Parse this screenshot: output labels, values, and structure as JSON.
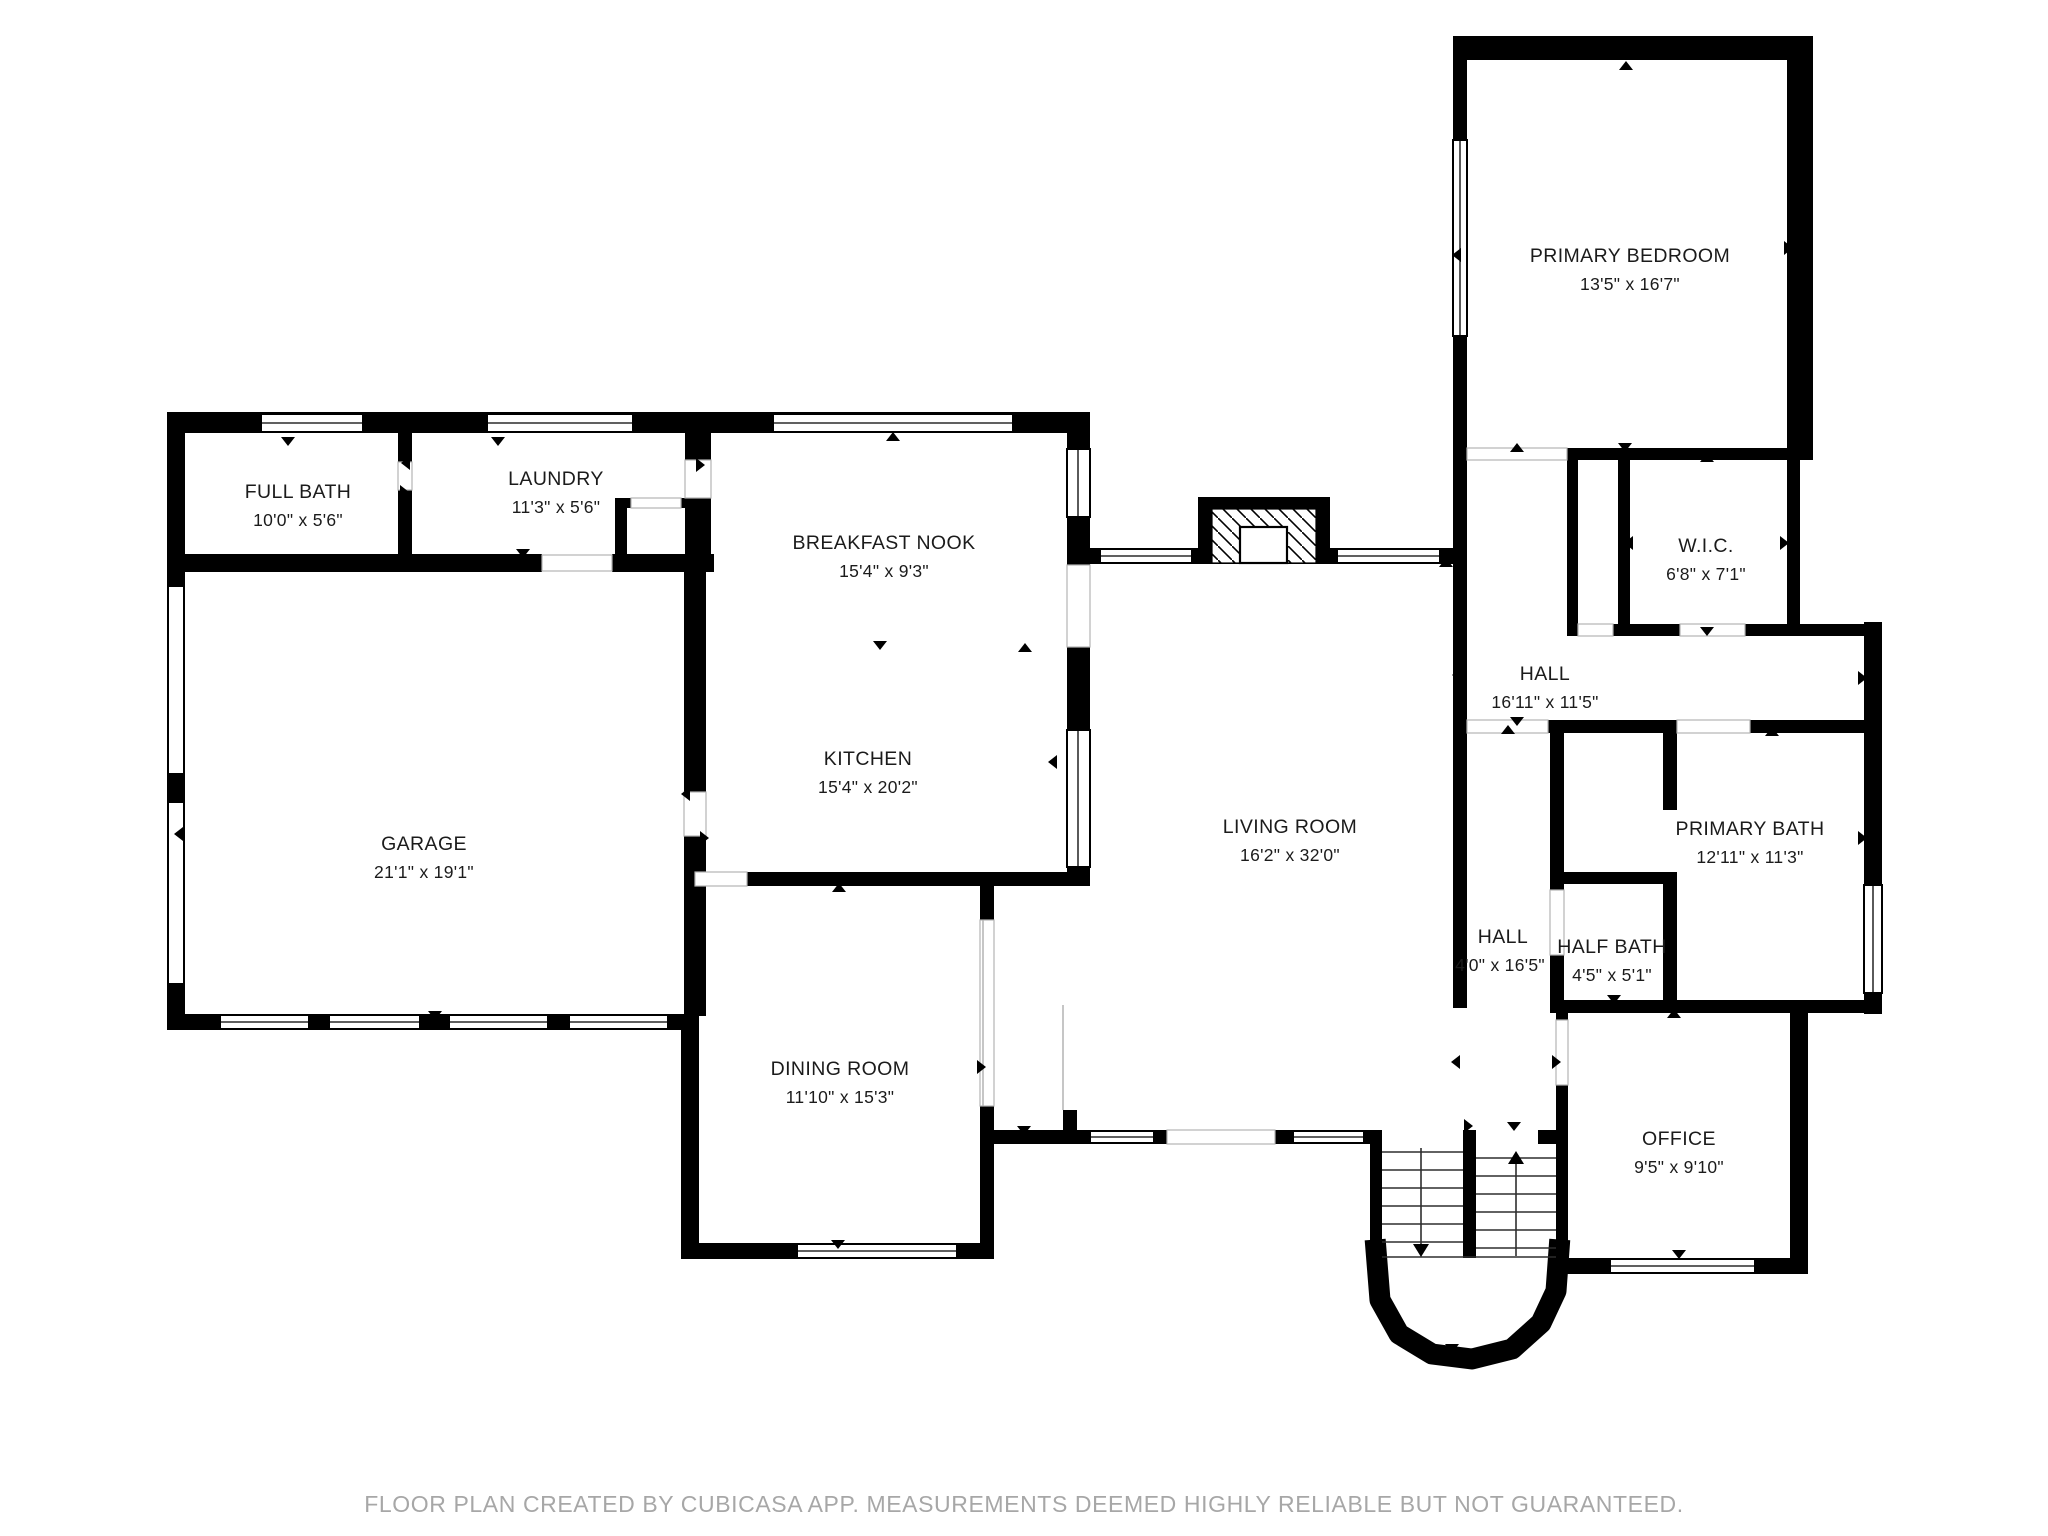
{
  "footer": {
    "text": "FLOOR PLAN CREATED BY CUBICASA APP. MEASUREMENTS DEEMED HIGHLY RELIABLE BUT NOT GUARANTEED."
  },
  "colors": {
    "wall": "#000000",
    "floor": "#ffffff",
    "label": "#1b1b1b",
    "footer": "#a7a7a7",
    "opening": "#b3b3b3",
    "tread": "#2e2e2e"
  },
  "rooms": [
    {
      "name": "PRIMARY BEDROOM",
      "dims": "13'5\" x 16'7\""
    },
    {
      "name": "FULL BATH",
      "dims": "10'0\" x 5'6\""
    },
    {
      "name": "LAUNDRY",
      "dims": "11'3\" x 5'6\""
    },
    {
      "name": "BREAKFAST NOOK",
      "dims": "15'4\" x 9'3\""
    },
    {
      "name": "W.I.C.",
      "dims": "6'8\" x 7'1\""
    },
    {
      "name": "HALL",
      "dims": "16'11\" x 11'5\""
    },
    {
      "name": "GARAGE",
      "dims": "21'1\" x 19'1\""
    },
    {
      "name": "KITCHEN",
      "dims": "15'4\" x 20'2\""
    },
    {
      "name": "LIVING ROOM",
      "dims": "16'2\" x 32'0\""
    },
    {
      "name": "PRIMARY BATH",
      "dims": "12'11\" x 11'3\""
    },
    {
      "name": "HALL",
      "dims": "4'0\" x 16'5\""
    },
    {
      "name": "HALF BATH",
      "dims": "4'5\" x 5'1\""
    },
    {
      "name": "DINING ROOM",
      "dims": "11'10\" x 15'3\""
    },
    {
      "name": "OFFICE",
      "dims": "9'5\" x 9'10\""
    }
  ]
}
